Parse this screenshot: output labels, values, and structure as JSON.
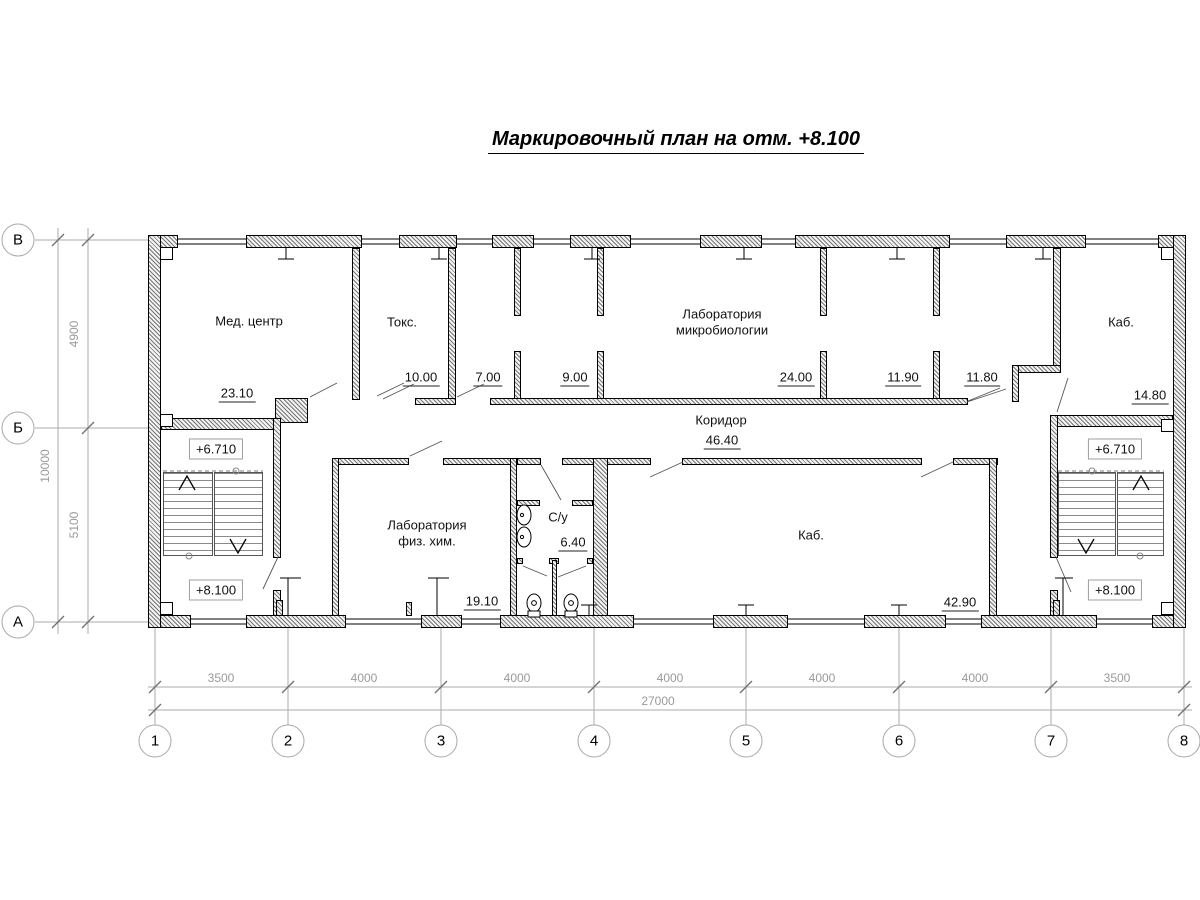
{
  "title": "Маркировочный план на отм. +8.100",
  "axis_letters": [
    "В",
    "Б",
    "А"
  ],
  "axis_numbers": [
    "1",
    "2",
    "3",
    "4",
    "5",
    "6",
    "7",
    "8"
  ],
  "dimensions": {
    "spans": [
      "3500",
      "4000",
      "4000",
      "4000",
      "4000",
      "4000",
      "3500"
    ],
    "total": "27000",
    "v_spans": [
      "4900",
      "5100"
    ],
    "v_total": "10000"
  },
  "rooms": {
    "med_center": {
      "label": "Мед. центр",
      "area": "23.10"
    },
    "toks": {
      "label": "Токс.",
      "area": "10.00"
    },
    "room_7": {
      "area": "7.00"
    },
    "room_9": {
      "area": "9.00"
    },
    "lab_micro": {
      "line1": "Лаборатория",
      "line2": "микробиологии",
      "area": "24.00"
    },
    "room_1190": {
      "area": "11.90"
    },
    "room_1180": {
      "area": "11.80"
    },
    "kab_upper": {
      "label": "Каб.",
      "area": "14.80"
    },
    "corridor": {
      "label": "Коридор",
      "area": "46.40"
    },
    "lab_fiz": {
      "line1": "Лаборатория",
      "line2": "физ. хим.",
      "area": "19.10"
    },
    "su": {
      "label": "С/у",
      "area": "6.40"
    },
    "kab_main": {
      "label": "Каб.",
      "area": "42.90"
    }
  },
  "elevations": {
    "left_upper": "+6.710",
    "left_lower": "+8.100",
    "right_upper": "+6.710",
    "right_lower": "+8.100"
  },
  "colors": {
    "line": "#000000",
    "dim_text": "#9a9a9a",
    "axis_line": "#aaaaaa",
    "hatch": "#777777"
  }
}
